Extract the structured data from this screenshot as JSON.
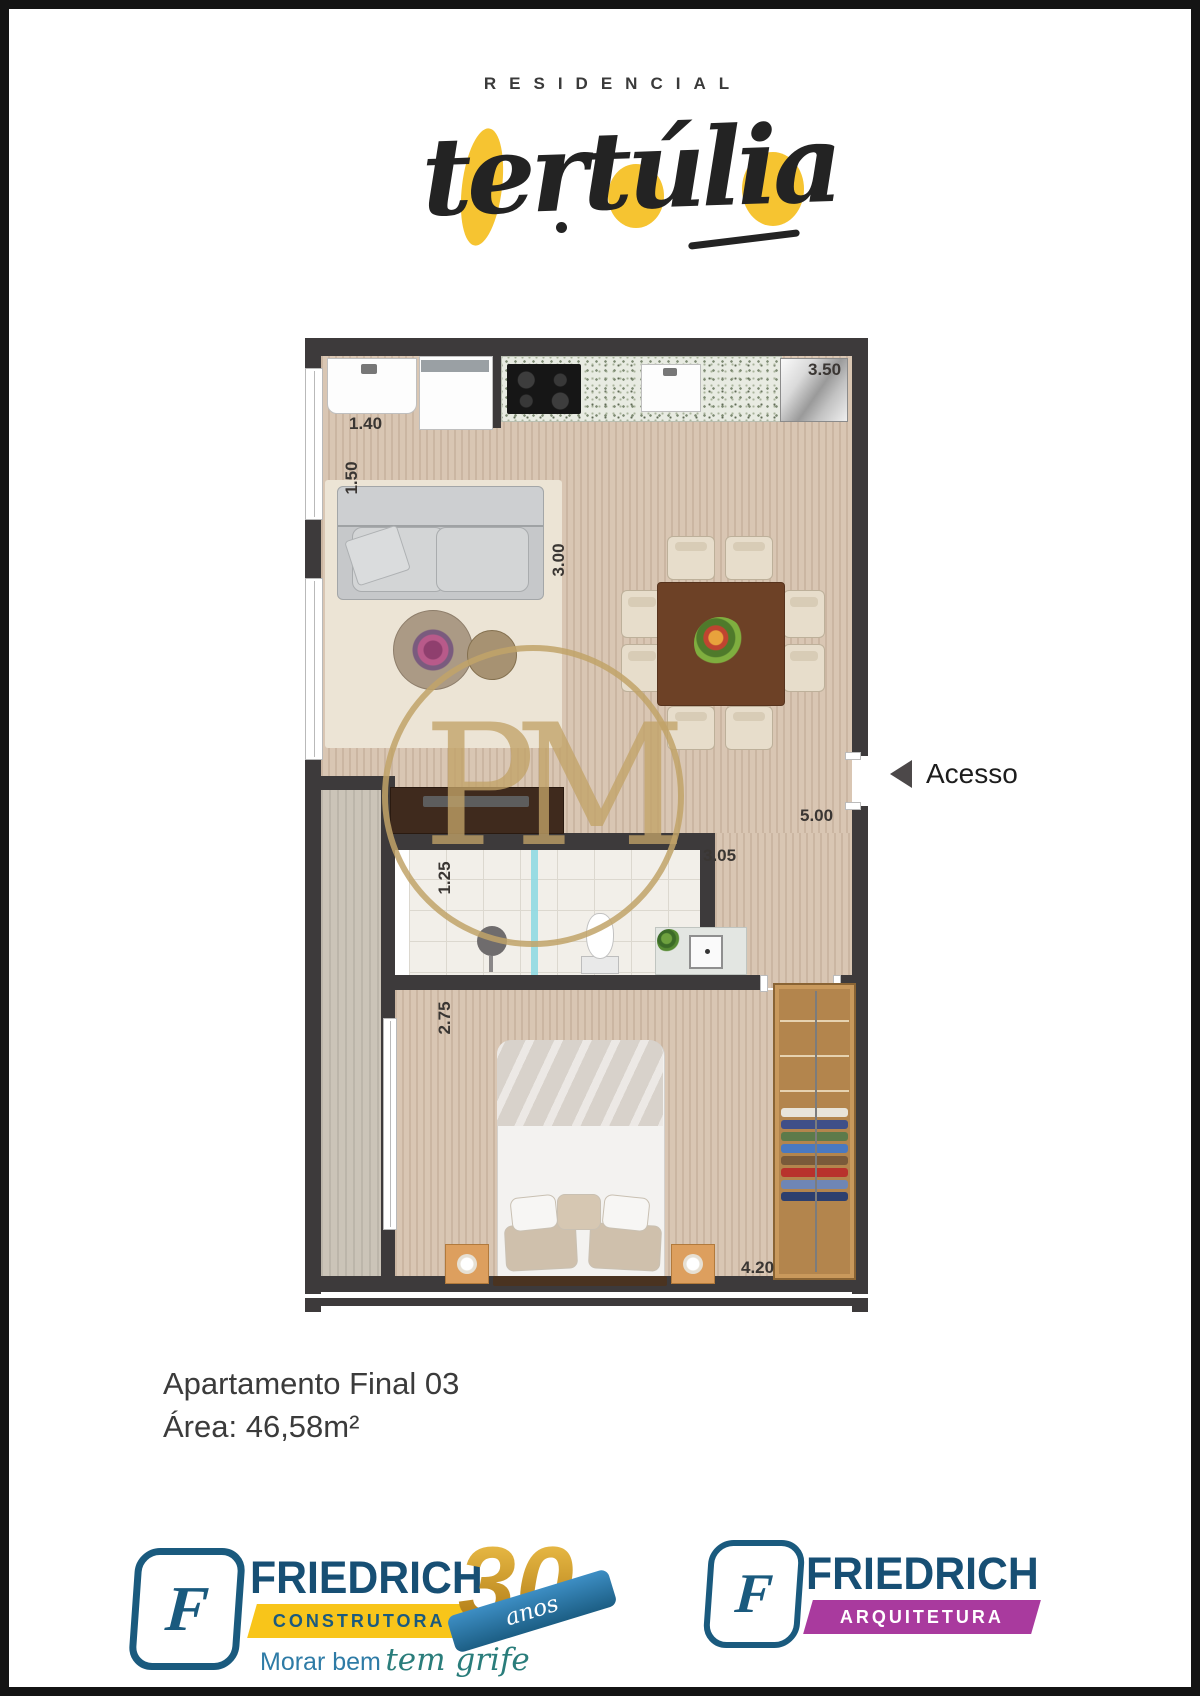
{
  "brand": {
    "residencial": "RESIDENCIAL",
    "name": "tertúlia"
  },
  "floor_plan": {
    "access_label": "Acesso",
    "watermark": "PM",
    "measurements": [
      {
        "label": "1.40"
      },
      {
        "label": "1.50"
      },
      {
        "label": "3.00"
      },
      {
        "label": "3.50"
      },
      {
        "label": "5.00"
      },
      {
        "label": "1.25"
      },
      {
        "label": "3.05"
      },
      {
        "label": "2.75"
      },
      {
        "label": "4.20"
      }
    ]
  },
  "details": {
    "apartment": "Apartamento Final 03",
    "area": "Área: 46,58m²"
  },
  "footer": {
    "construtora": {
      "monogram": "F",
      "brand": "FRIEDRICH",
      "label": "CONSTRUTORA",
      "tagline_plain": "Morar bem",
      "tagline_script": "tem grife",
      "years_number": "30",
      "years_word": "anos"
    },
    "arquitetura": {
      "monogram": "F",
      "brand": "FRIEDRICH",
      "label": "ARQUITETURA"
    }
  },
  "colors": {
    "accent_yellow": "#f6c431",
    "brand_blue": "#1a5a7e",
    "banner_magenta": "#a93a9e",
    "watermark_gold": "#c1a368",
    "wall": "#3d3a3b"
  }
}
